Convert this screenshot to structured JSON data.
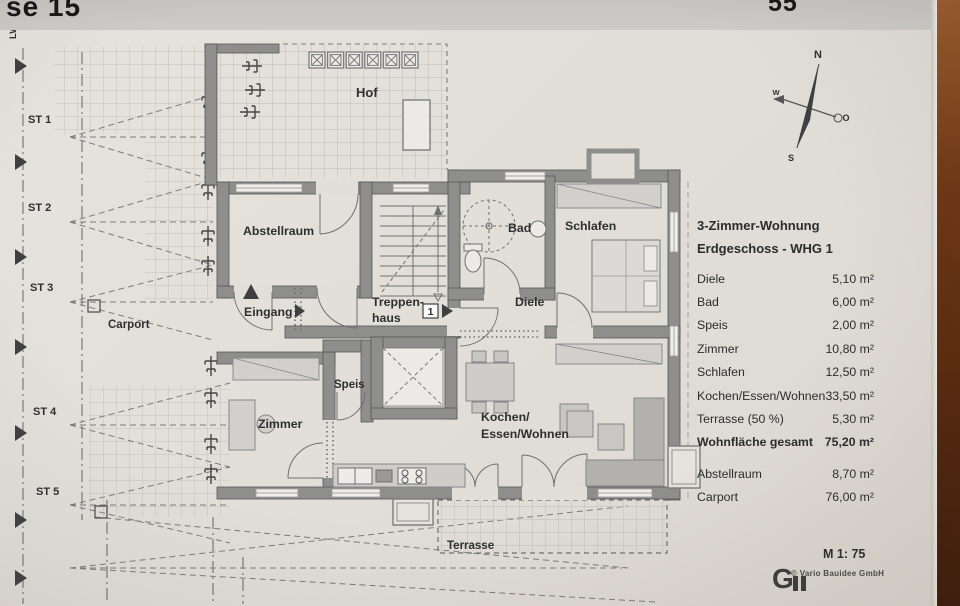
{
  "page": {
    "header_left": "se 15",
    "header_right": "55"
  },
  "plan": {
    "rooms": {
      "hof": "Hof",
      "lwwp": "LWWP",
      "abstellraum": "Abstellraum",
      "eingang": "Eingang",
      "treppenhaus_line1": "Treppen-",
      "treppenhaus_line2": "haus",
      "bad": "Bad",
      "schlafen": "Schlafen",
      "diele": "Diele",
      "speis": "Speis",
      "zimmer": "Zimmer",
      "kochen_line1": "Kochen/",
      "kochen_line2": "Essen/Wohnen",
      "terrasse": "Terrasse",
      "carport": "Carport"
    },
    "parking_spots": [
      "ST 1",
      "ST 2",
      "ST 3",
      "ST 4",
      "ST 5"
    ],
    "unit_marker": "1",
    "compass": {
      "north": "N",
      "south": "S",
      "west": "W",
      "east": "O"
    }
  },
  "legend": {
    "title_line1": "3-Zimmer-Wohnung",
    "title_line2": "Erdgeschoss - WHG 1",
    "rows": [
      {
        "label": "Diele",
        "value": "5,10 m²"
      },
      {
        "label": "Bad",
        "value": "6,00 m²"
      },
      {
        "label": "Speis",
        "value": "2,00 m²"
      },
      {
        "label": "Zimmer",
        "value": "10,80 m²"
      },
      {
        "label": "Schlafen",
        "value": "12,50 m²"
      },
      {
        "label": "Kochen/Essen/Wohnen",
        "value": "33,50 m²"
      },
      {
        "label": "Terrasse (50 %)",
        "value": "5,30 m²"
      },
      {
        "label": "Wohnfläche gesamt",
        "value": "75,20 m²"
      },
      {
        "label": "Abstellraum",
        "value": "8,70 m²"
      },
      {
        "label": "Carport",
        "value": "76,00 m²"
      }
    ]
  },
  "footer": {
    "scale": "M 1: 75",
    "logo_mark": "G",
    "credit": "© Vario Bauidee GmbH"
  },
  "colors": {
    "wall": "#8e8e8c",
    "paper": "#e2dfd9",
    "ink": "#2e2f31",
    "wood": "#5f2f12"
  }
}
